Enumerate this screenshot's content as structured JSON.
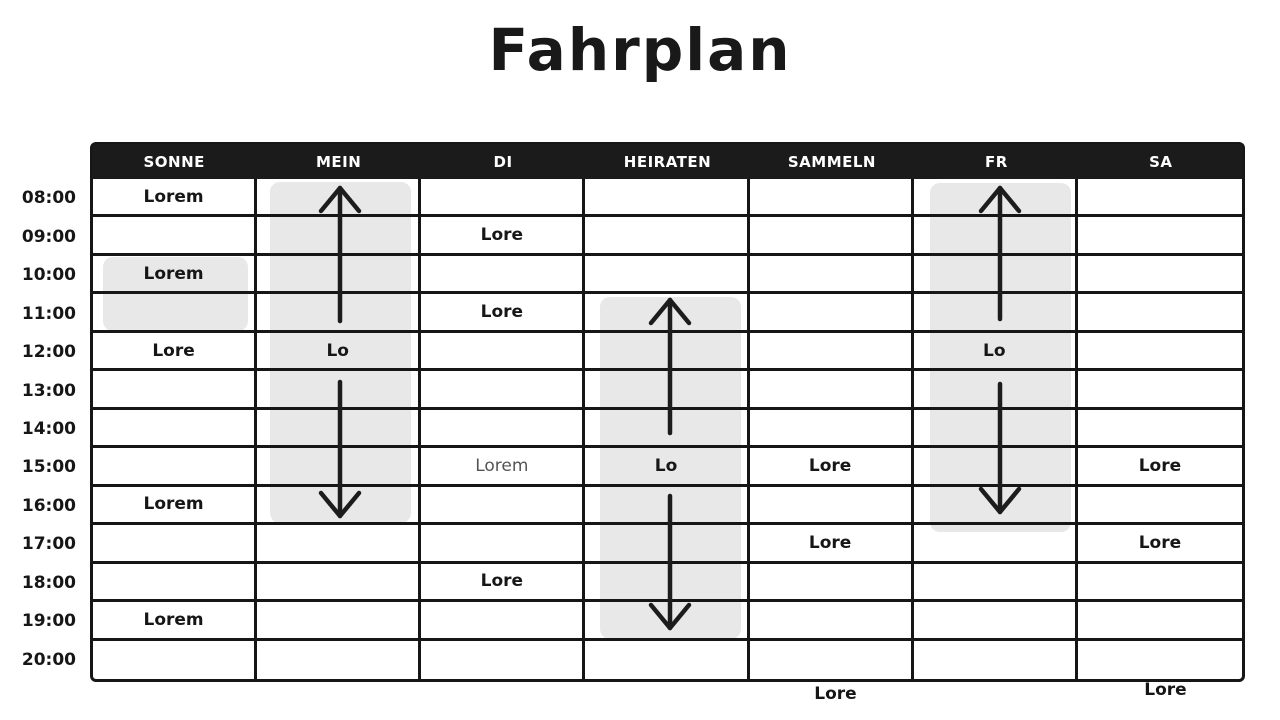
{
  "title": "Fahrplan",
  "table": {
    "days": [
      "SONNE",
      "MEIN",
      "DI",
      "HEIRATEN",
      "SAMMELN",
      "FR",
      "SA"
    ],
    "times": [
      "08:00",
      "09:00",
      "10:00",
      "11:00",
      "12:00",
      "13:00",
      "14:00",
      "15:00",
      "16:00",
      "17:00",
      "18:00",
      "19:00",
      "20:00"
    ],
    "cells": [
      [
        "Lorem",
        "",
        "",
        "",
        "",
        "",
        ""
      ],
      [
        "",
        "",
        "Lore",
        "",
        "",
        "",
        ""
      ],
      [
        "Lorem",
        "",
        "",
        "",
        "",
        "",
        ""
      ],
      [
        "",
        "",
        "Lore",
        "",
        "",
        "",
        ""
      ],
      [
        "Lore",
        "Lo",
        "",
        "",
        "",
        "Lo",
        ""
      ],
      [
        "",
        "",
        "",
        "",
        "",
        "",
        ""
      ],
      [
        "",
        "",
        "",
        "",
        "",
        "",
        ""
      ],
      [
        "",
        "",
        "Lorem",
        "Lo",
        "Lore",
        "",
        "Lore"
      ],
      [
        "Lorem",
        "",
        "",
        "",
        "",
        "",
        ""
      ],
      [
        "",
        "",
        "",
        "",
        "Lore",
        "",
        "Lore"
      ],
      [
        "",
        "",
        "Lore",
        "",
        "",
        "",
        ""
      ],
      [
        "Lorem",
        "",
        "",
        "",
        "",
        "",
        ""
      ],
      [
        "",
        "",
        "",
        "",
        "",
        "",
        ""
      ]
    ],
    "muted_cell": {
      "row": 7,
      "col": 2
    }
  },
  "highlights": [
    {
      "day": "SONNE",
      "from": "10:00",
      "to": "11:00",
      "label": "Lorem"
    },
    {
      "day": "MEIN",
      "from": "08:00",
      "to": "16:00",
      "midpoint_label": "Lo",
      "arrows": "up-down"
    },
    {
      "day": "HEIRATEN",
      "from": "11:00",
      "to": "19:00",
      "midpoint_label": "Lo",
      "arrows": "up-down"
    },
    {
      "day": "FR",
      "from": "08:00",
      "to": "16:00",
      "midpoint_label": "Lo",
      "arrows": "up-down"
    }
  ],
  "footer_labels": [
    {
      "under_day": "SAMMELN",
      "text": "Lore"
    },
    {
      "under_day": "SA",
      "text": "Lore"
    }
  ],
  "colors": {
    "background": "#ffffff",
    "header_bg": "#1b1b1b",
    "header_text": "#ffffff",
    "highlight_bg": "#e8e8e8",
    "line": "#161616",
    "text": "#161616",
    "muted_text": "#555555"
  }
}
